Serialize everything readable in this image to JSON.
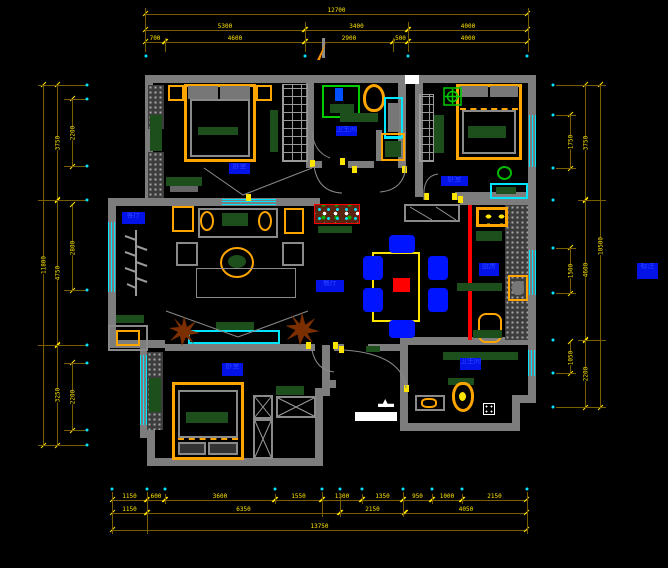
{
  "title": "apartment-floor-plan-cad",
  "palette": {
    "background": "#000000",
    "wall_gray": "#7d7d7d",
    "dimension_line": "#7a5c00",
    "dimension_text": "#ffe400",
    "window_cyan": "#00e5ff",
    "wood_orange": "#ffa500",
    "fabric_green": "#1d4f1d",
    "label_blue": "#0313e8",
    "chair_blue": "#0014ff",
    "accent_red": "#ff0000",
    "plant_brown": "#7b2f00",
    "shower_green": "#00cc00",
    "white": "#ffffff"
  },
  "rooms": {
    "master": "卧室",
    "bath1": "卫生间",
    "study": "卧室",
    "living": "客厅",
    "hall": "餐厅",
    "kitchen": "厨房",
    "bedroom2": "卧室",
    "bath2": "卫生间",
    "note": "标注"
  },
  "dims": {
    "top": {
      "r1": [
        "12700"
      ],
      "r2": [
        "5300",
        "3400",
        "4000"
      ],
      "r3": [
        "700",
        "4600",
        "2900",
        "500",
        "4000"
      ]
    },
    "bottom": {
      "r1": [
        "1150",
        "600",
        "3600",
        "1550",
        "1300",
        "1350",
        "950",
        "1000",
        "2150"
      ],
      "r2": [
        "1150",
        "6350",
        "2150",
        "4050"
      ],
      "r3": [
        "13750"
      ]
    },
    "left": {
      "outer": [
        "11800"
      ],
      "mid": [
        "3750",
        "4750",
        "3250"
      ],
      "inner": [
        "2200",
        "2800",
        "2200"
      ]
    },
    "right": {
      "outer": [
        "10500"
      ],
      "mid": [
        "3750",
        "4600",
        "2200"
      ],
      "inner": [
        "1750",
        "1500",
        "1050"
      ]
    }
  }
}
